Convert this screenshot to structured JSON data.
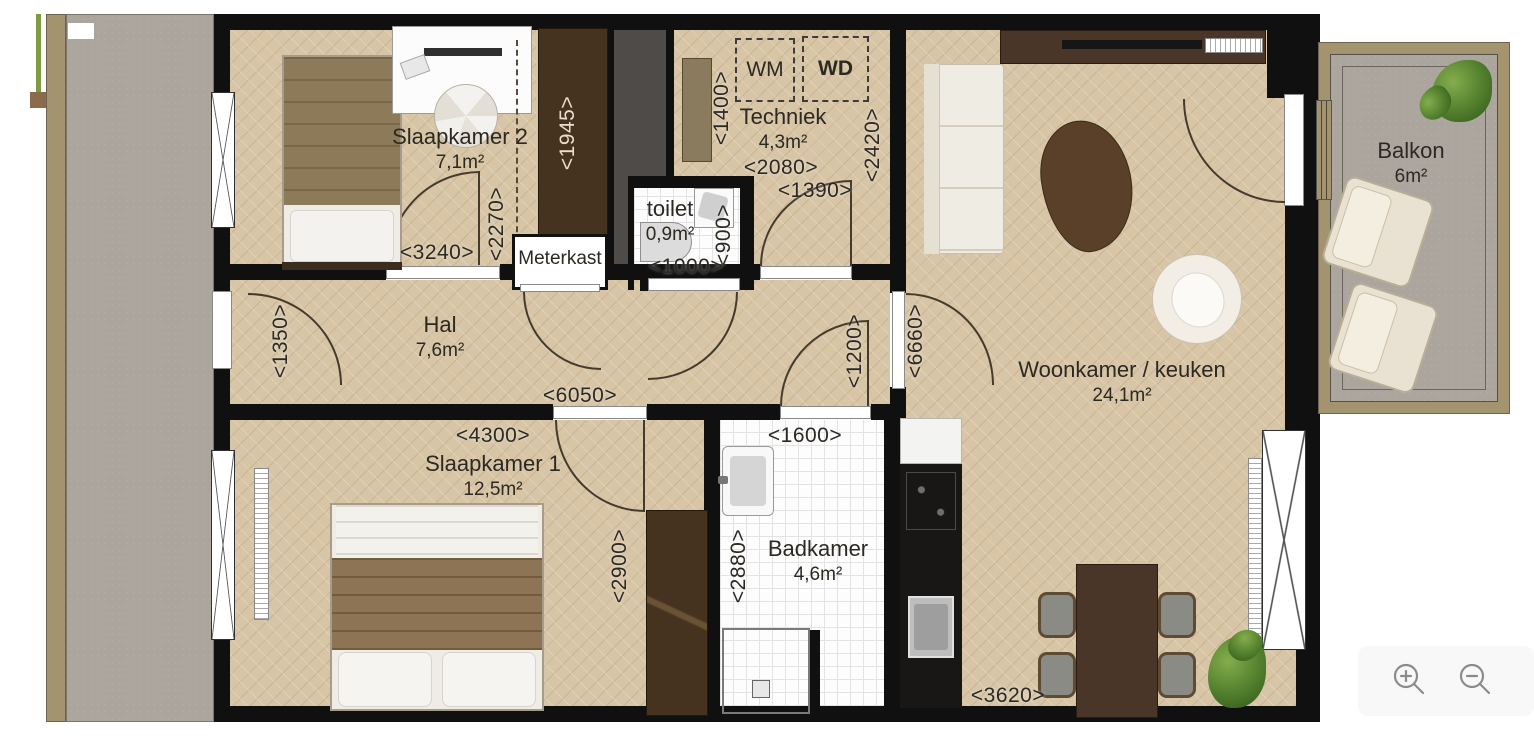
{
  "plan_title": "floorplan-apartment",
  "rooms": [
    {
      "name": "Slaapkamer 2",
      "area": "7,1m²"
    },
    {
      "name": "Techniek",
      "area": "4,3m²"
    },
    {
      "name": "toilet",
      "area": "0,9m²"
    },
    {
      "name": "Hal",
      "area": "7,6m²"
    },
    {
      "name": "Woonkamer / keuken",
      "area": "24,1m²"
    },
    {
      "name": "Slaapkamer 1",
      "area": "12,5m²"
    },
    {
      "name": "Badkamer",
      "area": "4,6m²"
    },
    {
      "name": "Balkon",
      "area": "6m²"
    }
  ],
  "labels": {
    "meterkast": "Meterkast",
    "wm": "WM",
    "wd": "WD"
  },
  "dimensions": [
    "<3240>",
    "<2270>",
    "<1945>",
    "<1400>",
    "<2080>",
    "<1390>",
    "<2420>",
    "<900>",
    "<1000>",
    "<1350>",
    "<6050>",
    "<1200>",
    "<6660>",
    "<4300>",
    "<2900>",
    "<1600>",
    "<2880>",
    "<3620>"
  ],
  "icons": {
    "zoom_in": "magnifier-plus",
    "zoom_out": "magnifier-minus"
  },
  "colors": {
    "wood_floor": "#d7c5a6",
    "wall": "#101010",
    "tile": "#fdfdfd",
    "concrete": "#aba59e",
    "dark_wood": "#46331f",
    "balcony_rim": "#a3936f",
    "text": "#2c2822"
  }
}
